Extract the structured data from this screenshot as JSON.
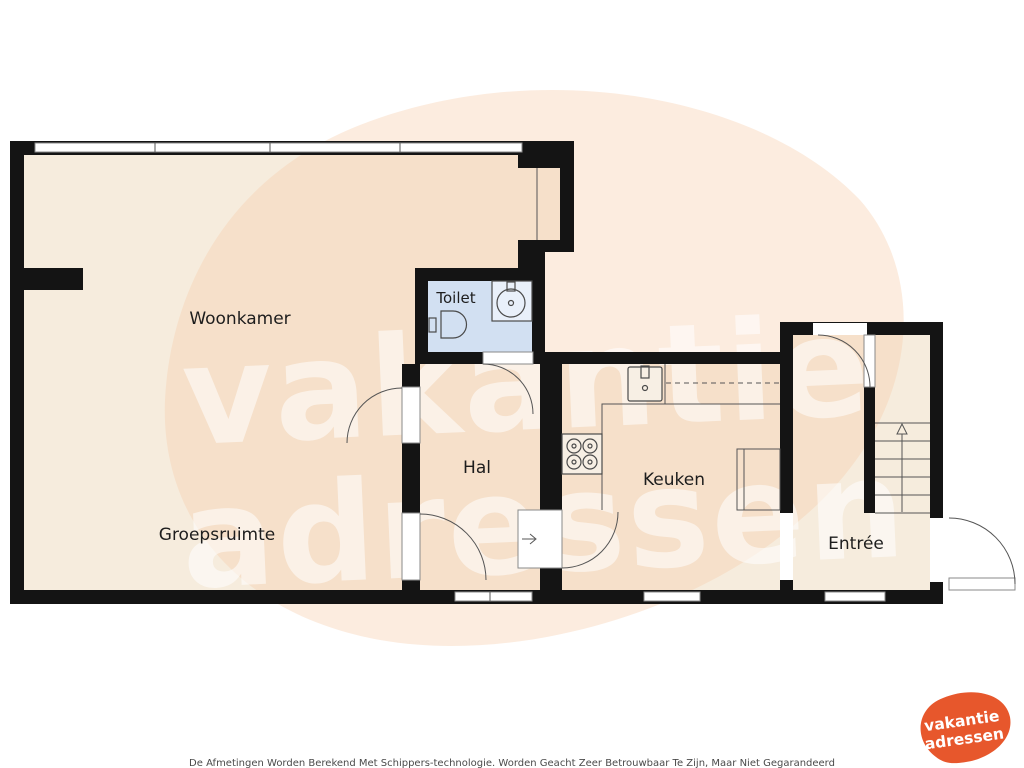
{
  "rooms": {
    "woonkamer": "Woonkamer",
    "groepsruimte": "Groepsruimte",
    "hal": "Hal",
    "toilet": "Toilet",
    "keuken": "Keuken",
    "entree": "Entrée"
  },
  "watermark": {
    "line1": "vakantie",
    "line2": "adressen"
  },
  "logo": {
    "line1": "vakantie",
    "line2": "adressen",
    "color": "#e7572c"
  },
  "disclaimer": {
    "text": "De Afmetingen Worden Berekend Met Schippers-technologie. Worden Geacht Zeer Betrouwbaar Te Zijn, Maar Niet Gegarandeerd"
  },
  "colors": {
    "wall": "#141414",
    "floor": "#f6ecdd",
    "toilet_floor": "#d2e0f2",
    "blob": "#f8cdaa",
    "accent": "#e7572c"
  }
}
